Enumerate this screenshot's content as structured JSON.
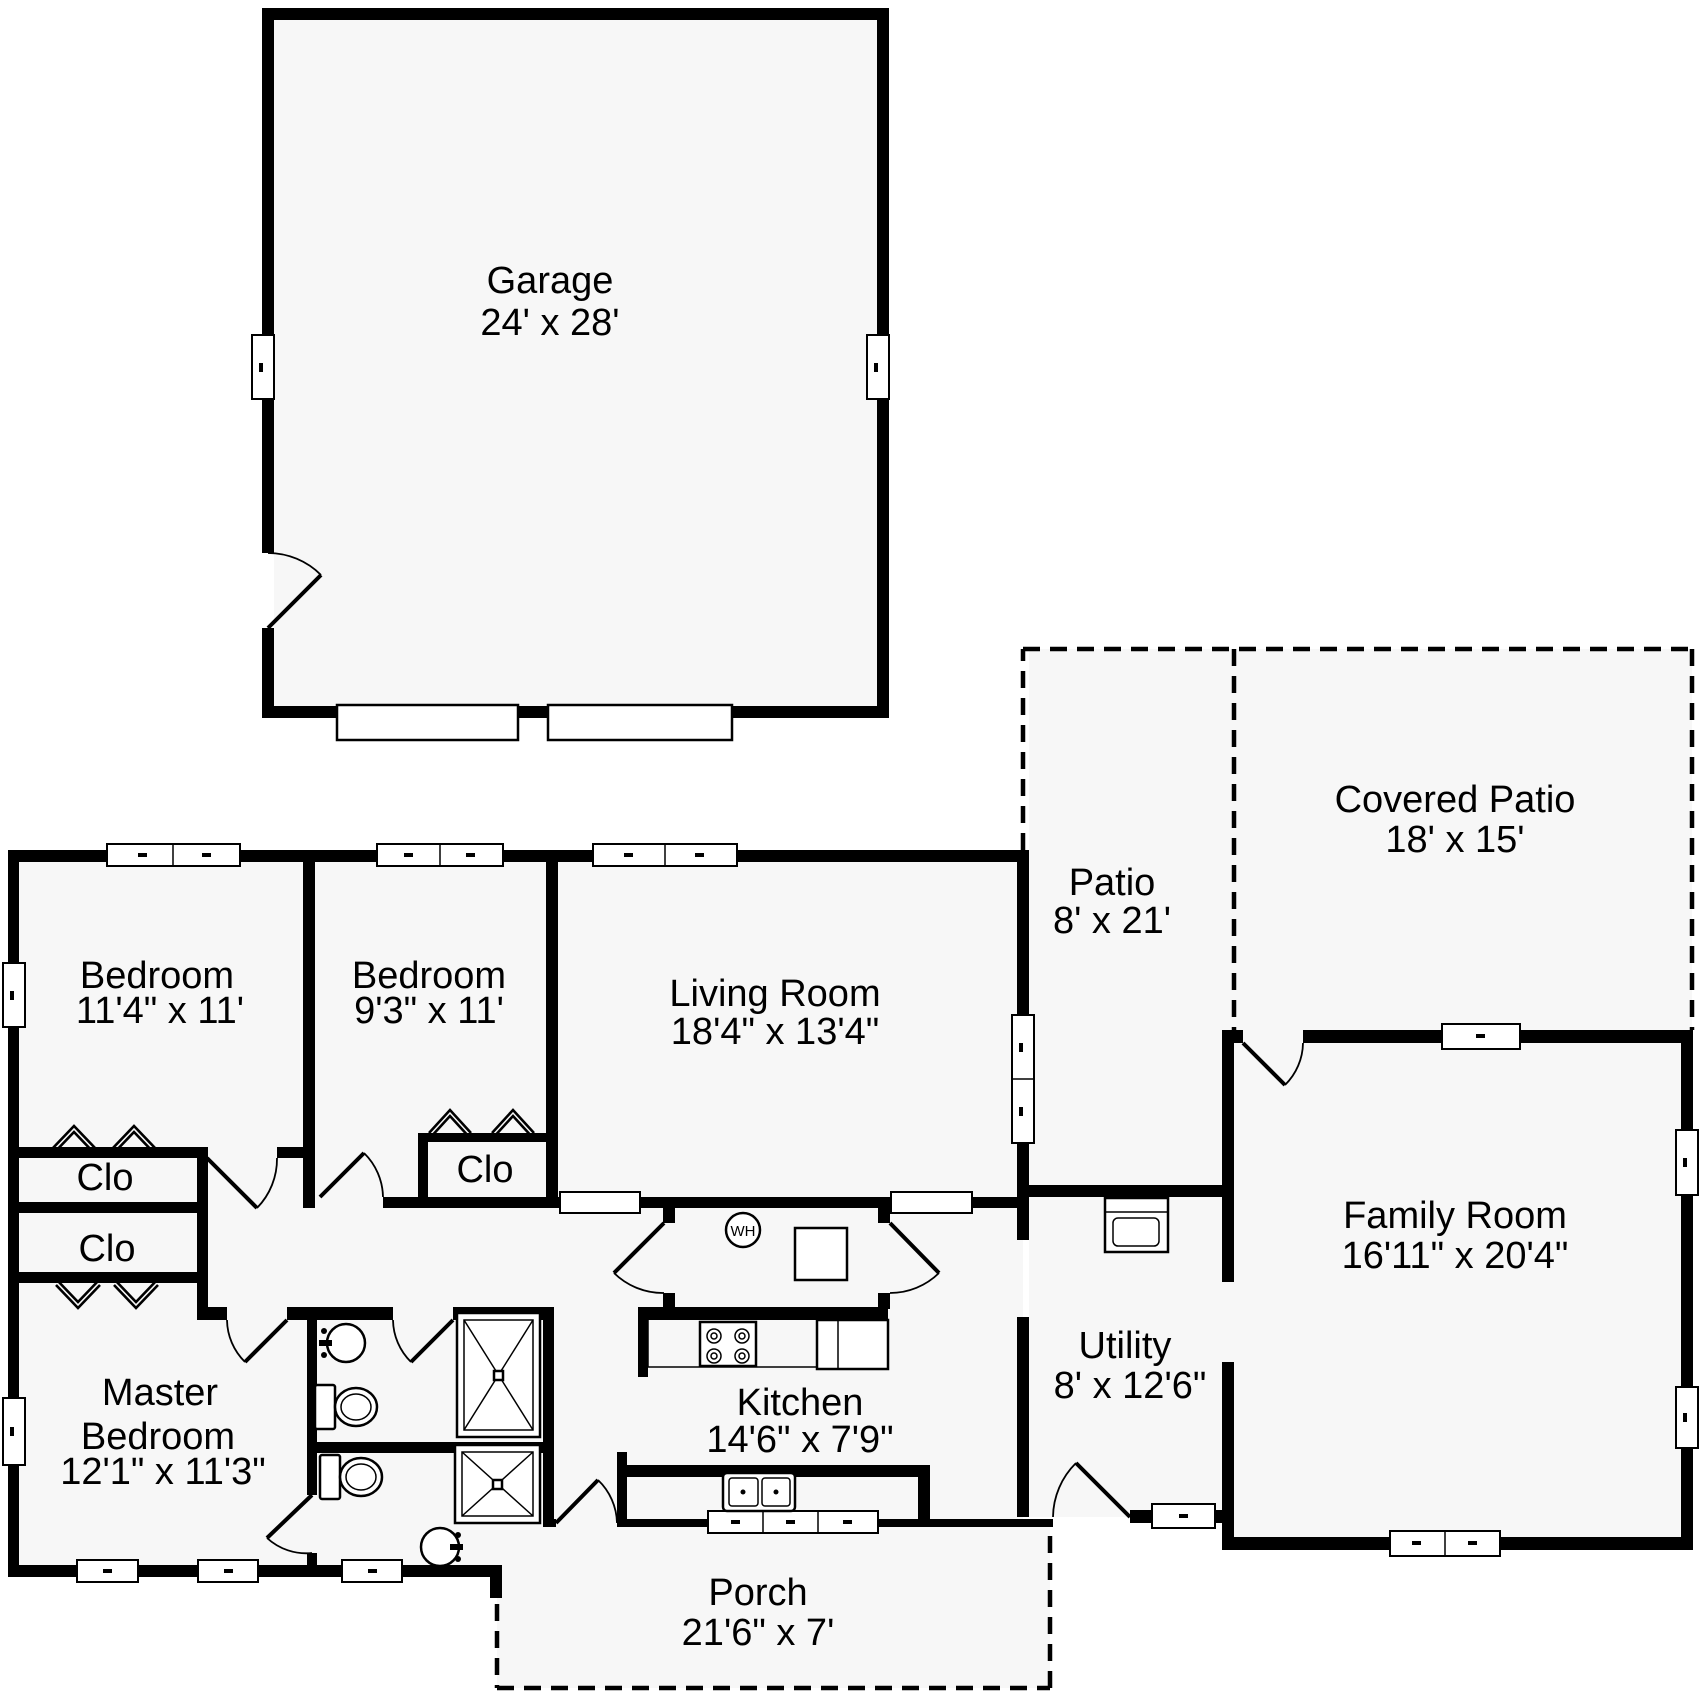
{
  "title": "Floor Plan",
  "colors": {
    "wall": "#000000",
    "floor": "#f7f7f7",
    "background": "#ffffff"
  },
  "rooms": {
    "garage": {
      "name": "Garage",
      "dims": "24' x 28'"
    },
    "bedroom1": {
      "name": "Bedroom",
      "dims": "11'4\" x 11'"
    },
    "bedroom2": {
      "name": "Bedroom",
      "dims": "9'3\" x 11'"
    },
    "living_room": {
      "name": "Living Room",
      "dims": "18'4\" x 13'4\""
    },
    "patio": {
      "name": "Patio",
      "dims": "8' x 21'"
    },
    "covered_patio": {
      "name": "Covered Patio",
      "dims": "18' x 15'"
    },
    "family_room": {
      "name": "Family Room",
      "dims": "16'11\" x 20'4\""
    },
    "utility": {
      "name": "Utility",
      "dims": "8' x 12'6\""
    },
    "kitchen": {
      "name": "Kitchen",
      "dims": "14'6\" x 7'9\""
    },
    "porch": {
      "name": "Porch",
      "dims": "21'6\" x 7'"
    },
    "master_bedroom": {
      "name_line1": "Master",
      "name_line2": "Bedroom",
      "dims": "12'1\" x 11'3\""
    }
  },
  "labels": {
    "closet": "Clo",
    "water_heater": "WH"
  },
  "icons": [
    "window-symbol",
    "door-swing-icon",
    "bifold-door-icon",
    "garage-door-icon",
    "water-heater-icon",
    "furnace-icon",
    "washer-icon",
    "range-icon",
    "refrigerator-icon",
    "kitchen-sink-icon",
    "bathroom-sink-icon",
    "toilet-icon",
    "shower-icon"
  ]
}
